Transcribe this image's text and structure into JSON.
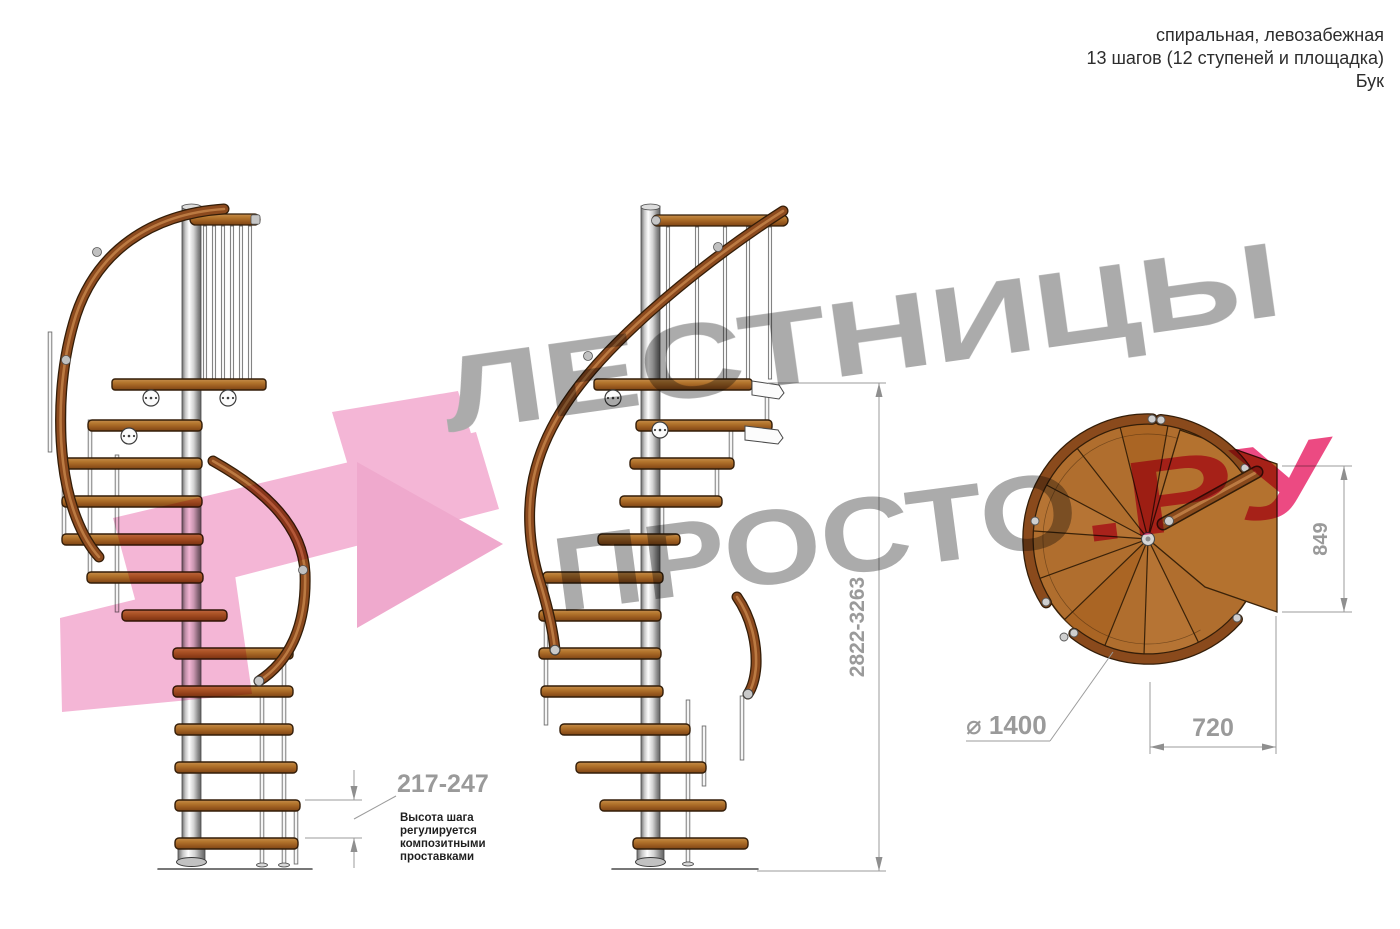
{
  "title_block": {
    "line1": "спиральная, левозабежная",
    "line2": "13 шагов (12 ступеней и площадка)",
    "line3": "Бук"
  },
  "watermark": {
    "word_top": "ЛЕСТНИЦЫ",
    "word_bottom": "ПРОСТО",
    "word_suffix": ".РУ"
  },
  "dimensions": {
    "total_height": "2822-3263",
    "plan_depth": "849",
    "plan_width": "720",
    "diameter": "⌀ 1400",
    "step_height": "217-247",
    "step_note": [
      "Высота шага",
      "регулируется",
      "композитными",
      "проставками"
    ]
  },
  "colors": {
    "dimension_gray": "#9a9a9a",
    "note_text": "#1f1f1f",
    "wood": "#b06e2e",
    "handrail": "#8c4a1e",
    "watermark_gray": "#ababab",
    "watermark_pink": "#ec4a82",
    "watermark_arrow_pink": "#f4b6d6"
  }
}
